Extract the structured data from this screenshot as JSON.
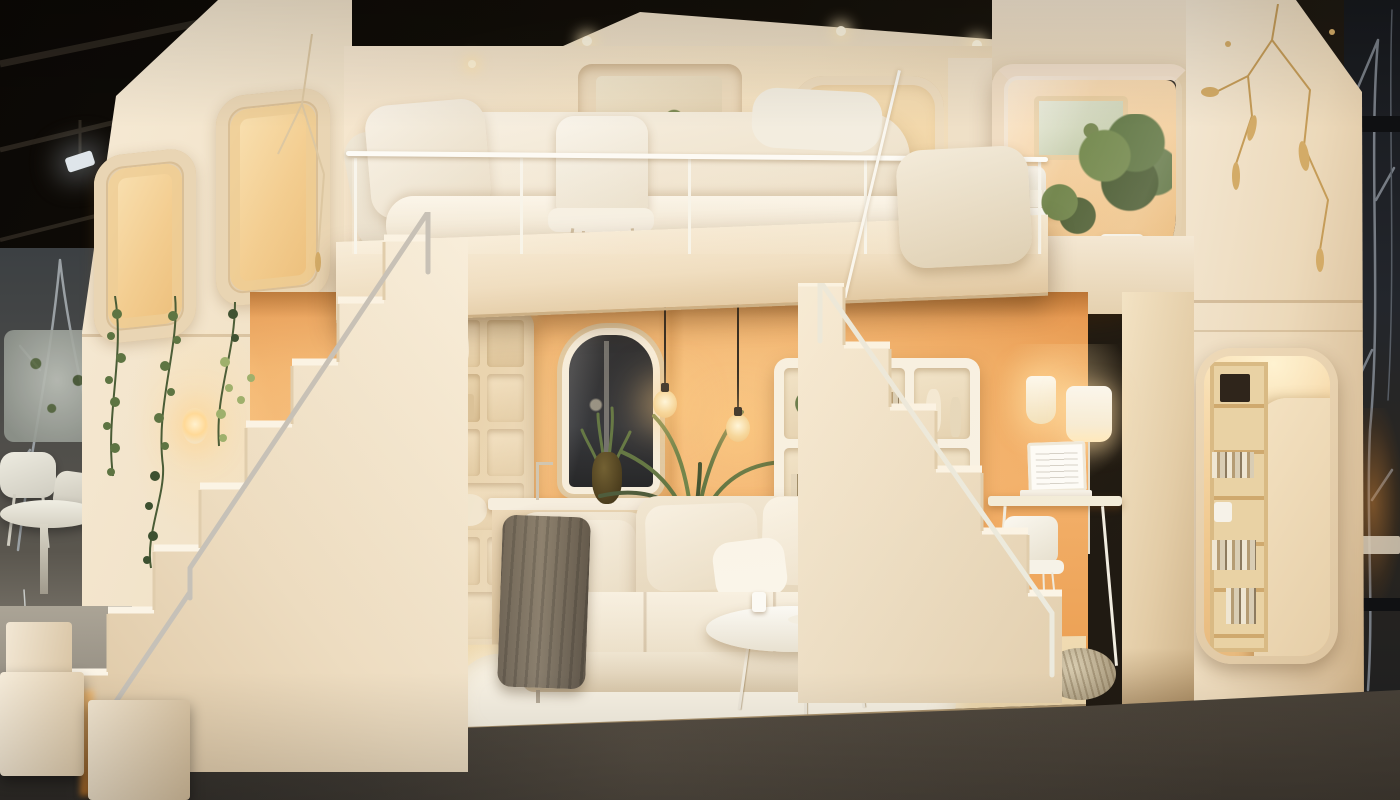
{
  "scene": {
    "type": "photograph",
    "setting": "furniture showroom at night",
    "description": "Cutaway two-story modular tiny-home display in a dark showroom: a cream dollhouse-style unit with rounded corners and gold kintsugi-style seam inlays. Upstairs is a bedroom with a plush white bed, a white shell chair and a glass balcony railing; a small plant-filled study sits in the upper-right module. Chunky white block staircases descend on both sides to a warm apricot-orange living room with a cream corner sofa, dark throw blanket, round white coffee table, glowing pendant bulbs, an arched dark window, cubby shelving, a wall shelf, a potted palm and a laptop desk nook. A backlit bookshelf niche is carved into the right tower, hanging ivy drapes the left facade, and the unit stands on a glossy dark-gray showroom floor with bare winter trees visible at both edges.",
    "objects": [
      {
        "name": "showroom-ceiling",
        "description": "black industrial ceiling with truss beams and a spotlight"
      },
      {
        "name": "bare-trees-left",
        "description": "bare winter branches behind the left edge"
      },
      {
        "name": "bare-trees-right",
        "description": "dark window with bare tree silhouettes on the right"
      },
      {
        "name": "display-set-left",
        "description": "white table and chairs of a neighboring room set"
      },
      {
        "name": "modular-house",
        "description": "cream two-story cutaway module with rounded corners"
      },
      {
        "name": "kintsugi-seams",
        "description": "gold crack-style inlay pattern on the cream facade"
      },
      {
        "name": "facade-windows",
        "description": "rounded-square window recesses glowing warm"
      },
      {
        "name": "bedroom",
        "description": "upstairs bedroom with white bed, pillows and art niche"
      },
      {
        "name": "bedroom-chair",
        "description": "white shell chair in front of the bed"
      },
      {
        "name": "balcony-railing",
        "description": "thin white railing with glass panels"
      },
      {
        "name": "upper-study",
        "description": "upper-right room with desk, chair and potted plants"
      },
      {
        "name": "left-staircase",
        "description": "chunky white block stairs descending left with metal handrail"
      },
      {
        "name": "right-staircase",
        "description": "white block stairs descending right into the living room"
      },
      {
        "name": "step-blocks",
        "description": "white cube steps at the lower-left corner"
      },
      {
        "name": "living-room",
        "description": "apricot-orange walled living room"
      },
      {
        "name": "pendant-bulbs",
        "description": "two glowing filament bulbs on black cords"
      },
      {
        "name": "arched-window",
        "description": "white-framed arched window with dark night glass"
      },
      {
        "name": "kitchenette-counter",
        "description": "white counter with faucet and dark stove niche"
      },
      {
        "name": "cubby-shelving",
        "description": "floor-to-ceiling cream cubby storage wall"
      },
      {
        "name": "wall-shelf",
        "description": "white wall shelf with books, plants and vases"
      },
      {
        "name": "palm-plant",
        "description": "potted palm behind the sofa"
      },
      {
        "name": "corner-sofa",
        "description": "cream sectional sofa with scatter cushions"
      },
      {
        "name": "throw-blanket",
        "description": "gray-brown throw draped over the sofa arm"
      },
      {
        "name": "coffee-table",
        "description": "round white coffee table with cups and a plate"
      },
      {
        "name": "area-rug",
        "description": "white shaggy rug on pale wood floor"
      },
      {
        "name": "wicker-pouf",
        "description": "small woven pouf at the stair foot"
      },
      {
        "name": "desk-nook",
        "description": "desk with laptop, chair, sconce and floor lamp"
      },
      {
        "name": "bookshelf-niche",
        "description": "backlit plywood bookshelf carved into the right tower"
      },
      {
        "name": "hanging-ivy",
        "description": "ivy strands hanging along the left facade"
      },
      {
        "name": "showroom-floor",
        "description": "glossy dark-gray showroom floor with reflections"
      }
    ],
    "palette": {
      "ceiling_black": "#0b0805",
      "beam_gray": "#2e2820",
      "spotlight_white": "#dfe5ea",
      "backdrop_left": "#474a4b",
      "branch_gray": "#9aa0a4",
      "backdrop_right": "#1b1e24",
      "branch_right": "#767c84",
      "cream": "#f0e2cc",
      "cream_bright": "#f8efdf",
      "cream_dark": "#d9c4a5",
      "gold": "#c59c58",
      "glow": "#f7d7a2",
      "orange_wall": "#efa65c",
      "orange_deep": "#de9145",
      "bed_white": "#f6f0e5",
      "rail_white": "#fcfbf7",
      "metal_gray": "#c6c1b8",
      "wood_floor": "#f0ddba",
      "rug_white": "#f7f1e4",
      "sofa_cream": "#f3ead9",
      "throw_gray": "#6f6557",
      "plant_green": "#5d7442",
      "plant_dark": "#3d5030",
      "lamp_glow": "#ffe9bc",
      "cord_dark": "#2b251e",
      "floor_gray": "#5d5852",
      "floor_dark": "#34312d",
      "shelf_wood": "#e8cfa0",
      "glass_dark": "#23262c",
      "wicker": "#cec0a4"
    }
  }
}
